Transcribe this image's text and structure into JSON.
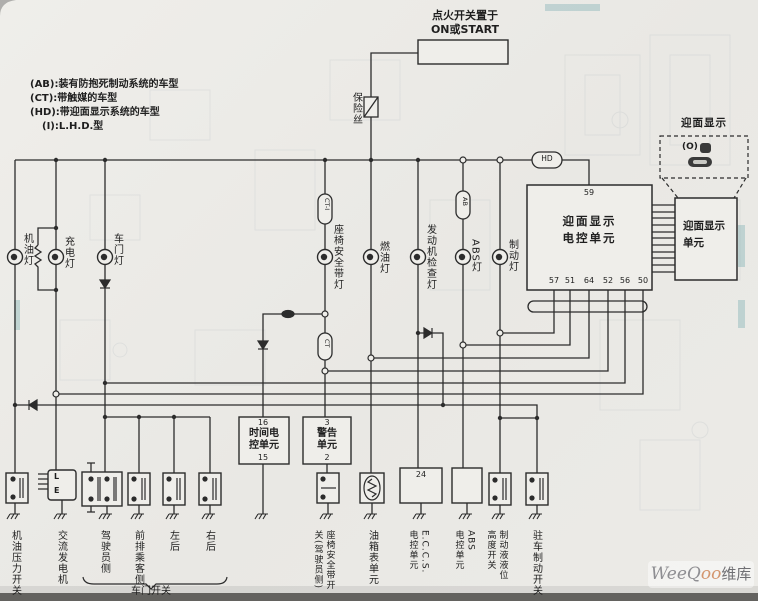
{
  "legend": {
    "lines": [
      "(AB):装有防抱死制动系统的车型",
      "(CT):带触媒的车型",
      "(HD):带迎面显示系统的车型",
      "(I):L.H.D.型"
    ]
  },
  "ignition": {
    "label_line1": "点火开关置于",
    "label_line2": "ON或START"
  },
  "fuse_label": "保险丝",
  "connectors": {
    "ct_i": "CT-I",
    "ab": "AB",
    "hd": "HD",
    "ct": "CT"
  },
  "lamps": [
    "机油灯",
    "充电灯",
    "车门灯",
    "座椅安全带灯",
    "燃油灯",
    "发动机检查灯",
    "ABS灯",
    "制动灯"
  ],
  "hud": {
    "display_label": "迎面显示",
    "icon_text": "(O)",
    "ecu_label_line1": "迎面显示",
    "ecu_label_line2": "电控单元",
    "ecu_pin_top": "59",
    "ecu_pins_bottom": [
      "57",
      "51",
      "64",
      "52",
      "56",
      "50"
    ],
    "unit_label_line1": "迎面显示",
    "unit_label_line2": "单元"
  },
  "units": {
    "timer": {
      "pin_top": "16",
      "line1": "时间电",
      "line2": "控单元",
      "pin_bottom": "15"
    },
    "warning": {
      "pin_top": "3",
      "line1": "警告",
      "line2": "单元",
      "pin_bottom": "2"
    },
    "eccs_pin": "24",
    "alternator_l": "L",
    "alternator_e": "E"
  },
  "bottom_labels": {
    "oil_pressure_switch": "机油压力开关",
    "alternator": "交流发电机",
    "door_driver": "驾驶员侧",
    "door_front_passenger": "前排乘客侧",
    "door_left_rear": "左后",
    "door_right_rear": "右后",
    "door_switch_group": "车门开关",
    "seat_belt_switch_col1": "座椅安全带开",
    "seat_belt_switch_col2": "关(驾驶员侧)",
    "fuel_gauge_unit": "油箱表单元",
    "eccs_col1": "E.C.C.S.",
    "eccs_col2": "电控单元",
    "abs_col1": "ABS",
    "abs_col2": "电控单元",
    "fluid_col1": "制动液液位",
    "fluid_col2": "高度开关",
    "parking_brake_switch": "驻车制动开关"
  },
  "watermark": {
    "part1": "WeeQ",
    "part2": "oo",
    "part3": "维库"
  }
}
